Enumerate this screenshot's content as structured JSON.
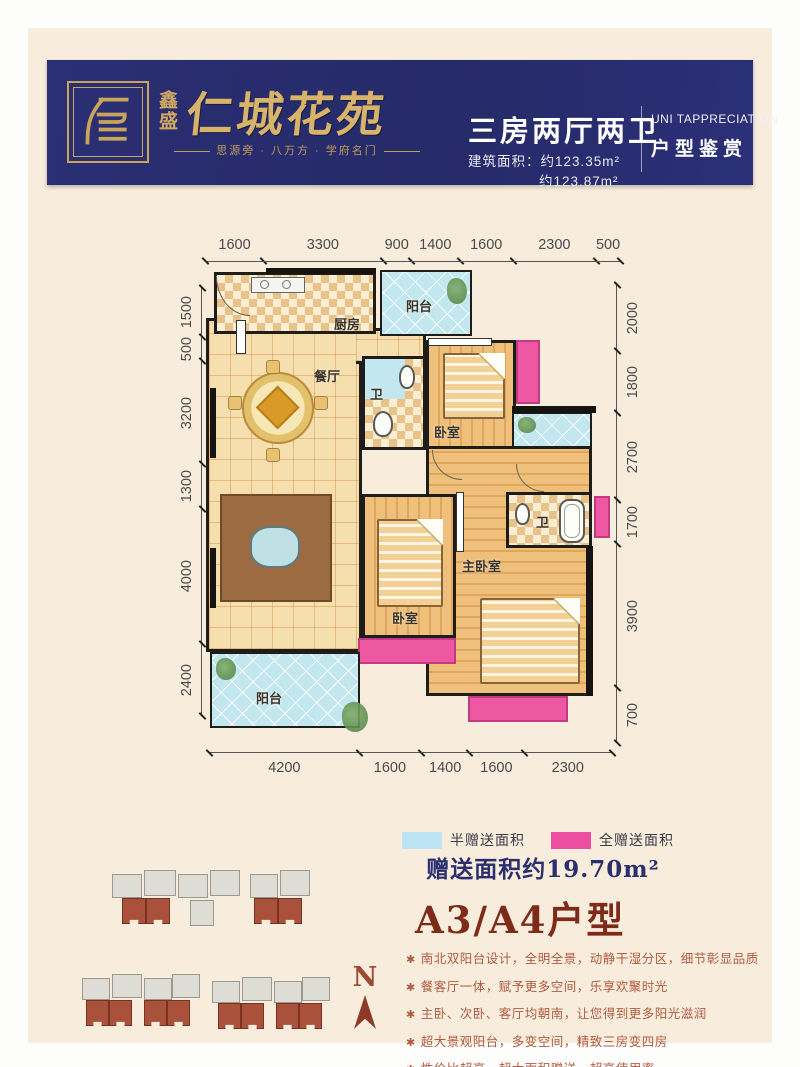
{
  "header": {
    "brand_small": "鑫盛",
    "brand_name": "仁城花苑",
    "tagline": "思源旁 · 八万方 · 学府名门",
    "unit_type": "三房两厅两卫",
    "area_line1": "建筑面积：约123.35m²",
    "area_line2": "约123.87m²",
    "en_title": "UNI TAPPRECIATION",
    "cn_subtitle": "户型鉴赏",
    "colors": {
      "banner": "#272b6e",
      "gold": "#c9a45c"
    }
  },
  "plan": {
    "dims_top": [
      "1600",
      "3300",
      "900",
      "1400",
      "1600",
      "2300",
      "500"
    ],
    "dims_bottom": [
      "4200",
      "1600",
      "1400",
      "1600",
      "2300"
    ],
    "dims_left": [
      "1500",
      "500",
      "3200",
      "1300",
      "4000",
      "2400"
    ],
    "dims_right": [
      "2000",
      "1800",
      "2700",
      "1700",
      "3900",
      "700"
    ],
    "rooms": {
      "kitchen": "厨房",
      "balcony_top": "阳台",
      "dining": "餐厅",
      "bath1": "卫",
      "bedroom_top": "卧室",
      "multi": "多功能房",
      "living": "客厅",
      "bedroom_mid": "卧室",
      "master": "主卧室",
      "bath2": "卫",
      "balcony_bottom": "阳台"
    }
  },
  "legend": {
    "half_label": "半赠送面积",
    "full_label": "全赠送面积",
    "half_color": "#bce4f2",
    "full_color": "#ec4f9f",
    "gift_text": "赠送面积约19.70m²"
  },
  "summary": {
    "title": "A3/A4户型",
    "bullet_char": "✱",
    "bullets": [
      "南北双阳台设计，全明全景，动静干湿分区，细节彰显品质",
      "餐客厅一体，赋予更多空间，乐享欢聚时光",
      "主卧、次卧、客厅均朝南，让您得到更多阳光滋润",
      "超大景观阳台，多变空间，精致三房变四房",
      "性价比超高，超大面积赠送，超高使用率"
    ]
  },
  "compass": {
    "label": "N"
  }
}
